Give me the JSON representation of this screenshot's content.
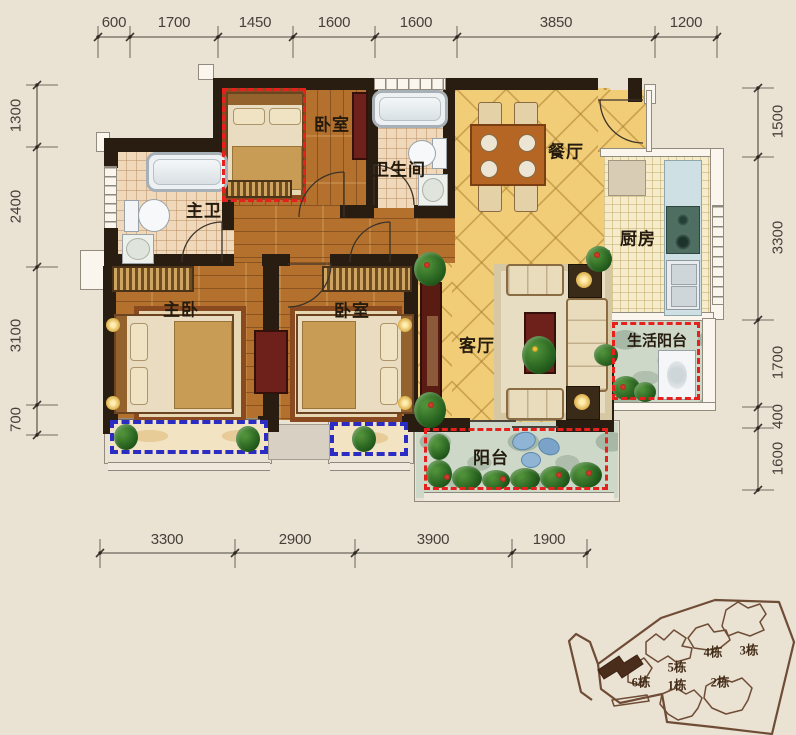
{
  "plan": {
    "rooms": {
      "bedroom_top": "卧室",
      "bathroom": "卫生间",
      "dining": "餐厅",
      "kitchen": "厨房",
      "master_bath": "主卫",
      "master_bedroom": "主卧",
      "bedroom2": "卧室",
      "living": "客厅",
      "utility_balcony": "生活阳台",
      "balcony": "阳台"
    },
    "colors": {
      "wall": "#291c10",
      "tile_yellow": "#f2cd77",
      "wood": "#b4712d",
      "bath_tile": "#f0d8bb",
      "stone": "#ced8c9",
      "red_dash": "#e6201c",
      "blue_dash": "#2b2cc4"
    }
  },
  "dimensions": {
    "top": [
      "600",
      "1700",
      "1450",
      "1600",
      "1600",
      "3850",
      "1200"
    ],
    "bottom": [
      "3300",
      "2900",
      "3900",
      "1900"
    ],
    "left": [
      "1300",
      "2400",
      "3100",
      "700"
    ],
    "right": [
      "1500",
      "3300",
      "1700",
      "400",
      "1600"
    ]
  },
  "sitemap": {
    "buildings": [
      "1栋",
      "2栋",
      "3栋",
      "4栋",
      "5栋",
      "6栋"
    ]
  }
}
